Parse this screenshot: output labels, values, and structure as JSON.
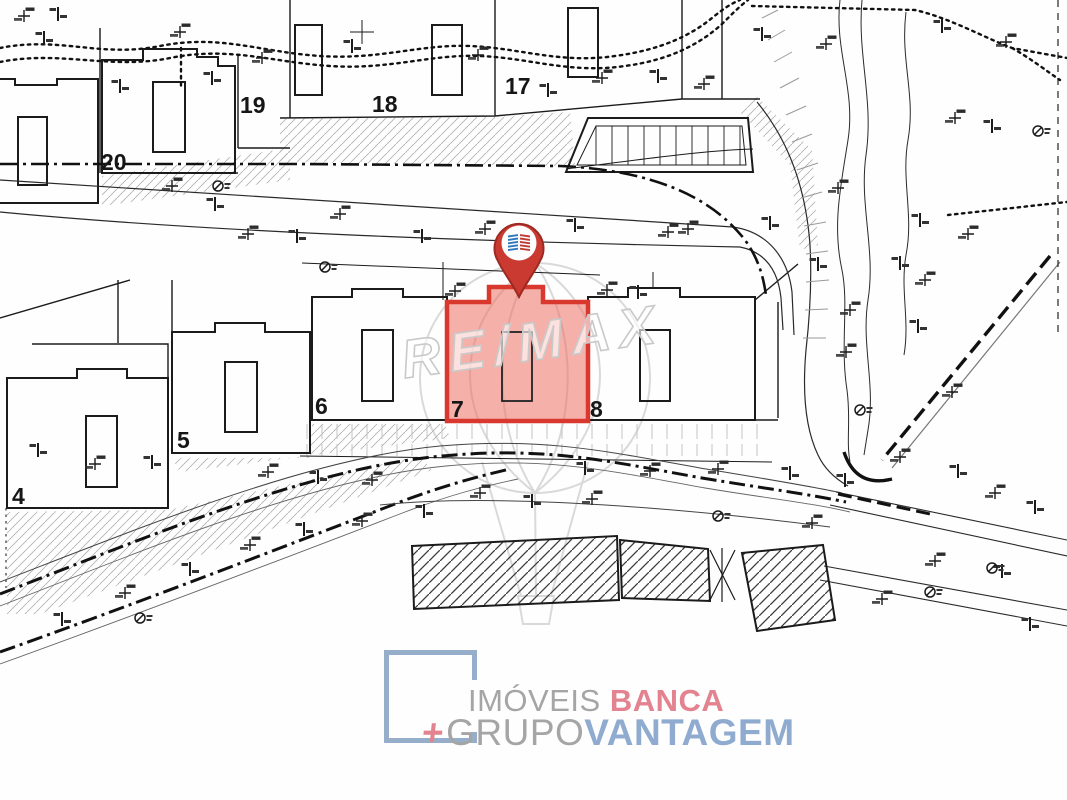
{
  "map": {
    "plots": [
      {
        "label": "20"
      },
      {
        "label": "19"
      },
      {
        "label": "18"
      },
      {
        "label": "17"
      },
      {
        "label": "4"
      },
      {
        "label": "5"
      },
      {
        "label": "6"
      },
      {
        "label": "7"
      },
      {
        "label": "8"
      }
    ],
    "highlighted_plot": "7",
    "watermark": "RE/MAX",
    "colors": {
      "highlight_stroke": "#d8382e",
      "highlight_fill": "#ee6f64",
      "pin_red": "#ca3a31",
      "pin_logo_blue": "#2f77bd",
      "pin_logo_red": "#bf3a33",
      "linework": "#1b1b1b",
      "watermark_gray": "#d6d6d6"
    }
  },
  "branding": {
    "imoveis": "IMÓVEIS",
    "banca": "BANCA",
    "plus": "+",
    "grupo": "GRUPO",
    "vantagem": "VANTAGEM",
    "colors": {
      "gray": "#a5a5a5",
      "pink": "#e2838f",
      "blue": "#8fabcf"
    }
  }
}
